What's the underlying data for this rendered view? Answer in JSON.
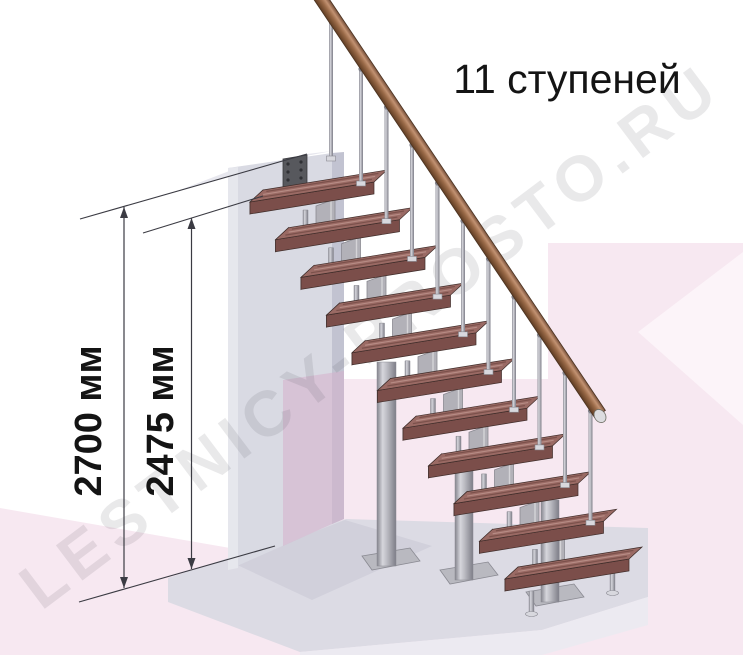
{
  "title": "11 ступеней",
  "watermark": "LESTNICY-PROSTO.RU",
  "dimensions": [
    {
      "label": "2700 мм",
      "x": 124,
      "y1": 207,
      "y2": 588,
      "lx": 101,
      "ly": 421
    },
    {
      "label": "2475 мм",
      "x": 191.5,
      "y1": 218,
      "y2": 569,
      "lx": 173,
      "ly": 421
    }
  ],
  "extension_lines": [
    [
      80,
      219,
      307,
      154
    ],
    [
      143,
      233,
      263,
      196
    ],
    [
      79,
      602,
      275,
      546
    ]
  ],
  "colors": {
    "pink": "#f7e8f1",
    "pinkLight": "#fcf4f9",
    "mauve": "rgba(213,176,204,0.55)",
    "slabTop": "#dcdbe4",
    "slabFront": "#eceaf1",
    "slabShadow": "#d1d0db",
    "upperFloor": "#e7e7ee",
    "wall": "#d9dae3",
    "wallSide": "#c2c3d1",
    "wallEdge": "#e6e7ed",
    "plate": "#57585d",
    "plateHole": "#2f3034",
    "treadTop": "#9a6a64",
    "treadFront": "#7b4e4a",
    "treadEnd": "#673e3c",
    "treadLine": "#3f2d2a",
    "grainDark": "rgba(58,28,24,0.32)",
    "grainLight": "rgba(255,228,216,0.28)",
    "metalMid": "#b9b9c0",
    "metalDark": "#84848d",
    "metalLight": "#d8d8de",
    "module": "#b2b1b8",
    "moduleEdge": "#8a8a92",
    "railStroke": "#4a3322",
    "railCap": "#dcdcdf",
    "dim": "#3b3b43",
    "text": "#141414",
    "watermark": "rgba(70,70,82,0.12)"
  },
  "scene": {
    "bg": [
      {
        "fill": "pink",
        "pts": [
          [
            0,
            508
          ],
          [
            230,
            548
          ],
          [
            233,
            562
          ],
          [
            282,
            562
          ],
          [
            282,
            379
          ],
          [
            548,
            379
          ],
          [
            548,
            243
          ],
          [
            743,
            243
          ],
          [
            743,
            655
          ],
          [
            0,
            655
          ]
        ]
      },
      {
        "fill": "pinkLight",
        "pts": [
          [
            743,
            252
          ],
          [
            638,
            332
          ],
          [
            743,
            425
          ]
        ]
      },
      {
        "fill": "slabTop",
        "pts": [
          [
            168,
            578
          ],
          [
            346,
            519
          ],
          [
            648,
            528
          ],
          [
            648,
            597
          ],
          [
            542,
            630
          ],
          [
            300,
            652
          ],
          [
            168,
            602
          ]
        ]
      },
      {
        "fill": "slabShadow",
        "pts": [
          [
            233,
            563
          ],
          [
            345,
            520
          ],
          [
            432,
            546
          ],
          [
            312,
            600
          ]
        ]
      },
      {
        "fill": "slabFront",
        "pts": [
          [
            648,
            597
          ],
          [
            542,
            630
          ],
          [
            542,
            655
          ],
          [
            648,
            625
          ]
        ]
      },
      {
        "fill": "slabFront",
        "pts": [
          [
            542,
            630
          ],
          [
            300,
            652
          ],
          [
            300,
            655
          ],
          [
            542,
            655
          ]
        ]
      },
      {
        "fill": "upperFloor",
        "pts": [
          [
            172,
            193
          ],
          [
            307,
            154
          ],
          [
            332,
            151
          ],
          [
            232,
            170
          ]
        ]
      }
    ],
    "wall": {
      "face": [
        [
          228,
          168
        ],
        [
          332,
          153
        ],
        [
          332,
          524
        ],
        [
          228,
          570
        ]
      ],
      "side": [
        [
          332,
          153
        ],
        [
          344,
          152
        ],
        [
          344,
          519
        ],
        [
          332,
          524
        ]
      ],
      "edge": [
        [
          228,
          168
        ],
        [
          238,
          167
        ],
        [
          238,
          568
        ],
        [
          228,
          570
        ]
      ],
      "mauve": [
        [
          283,
          380
        ],
        [
          344,
          371
        ],
        [
          344,
          519
        ],
        [
          332,
          524
        ],
        [
          283,
          546
        ]
      ],
      "plate": [
        [
          283,
          159
        ],
        [
          307,
          155
        ],
        [
          307,
          187
        ],
        [
          283,
          191
        ]
      ],
      "holes": [
        [
          288,
          164
        ],
        [
          301,
          162
        ],
        [
          288,
          172
        ],
        [
          301,
          170
        ],
        [
          288,
          180
        ],
        [
          301,
          178
        ]
      ]
    },
    "stairs": {
      "count": 11,
      "ox": 250,
      "oy": 202,
      "dx": 25.5,
      "dy": 37.7,
      "lenx": 124,
      "leny": -20,
      "depx": 13,
      "depy": -12,
      "thick": 12,
      "bal_off": 111
    },
    "rail": {
      "x1": 318,
      "y1": -6,
      "x2": 600,
      "y2": 414,
      "hw": 6.5
    },
    "landing_baluster": {
      "x": 331,
      "y1": 16,
      "y2": 160
    },
    "columns": [
      {
        "x": 377,
        "w": 19,
        "y1": 362,
        "y2": 566,
        "plate": [
          [
            362,
            556
          ],
          [
            410,
            548
          ],
          [
            420,
            561
          ],
          [
            372,
            570
          ]
        ]
      },
      {
        "x": 455,
        "w": 18,
        "y1": 470,
        "y2": 580,
        "plate": [
          [
            440,
            570
          ],
          [
            488,
            562
          ],
          [
            498,
            575
          ],
          [
            450,
            584
          ]
        ]
      },
      {
        "x": 541,
        "w": 18,
        "y1": 500,
        "y2": 602,
        "plate": [
          [
            526,
            592
          ],
          [
            574,
            584
          ],
          [
            584,
            597
          ],
          [
            536,
            606
          ]
        ]
      }
    ],
    "legs": [
      {
        "x": 529,
        "w": 5,
        "y1": 591,
        "y2": 614
      },
      {
        "x": 610,
        "w": 5,
        "y1": 558,
        "y2": 593
      }
    ]
  }
}
